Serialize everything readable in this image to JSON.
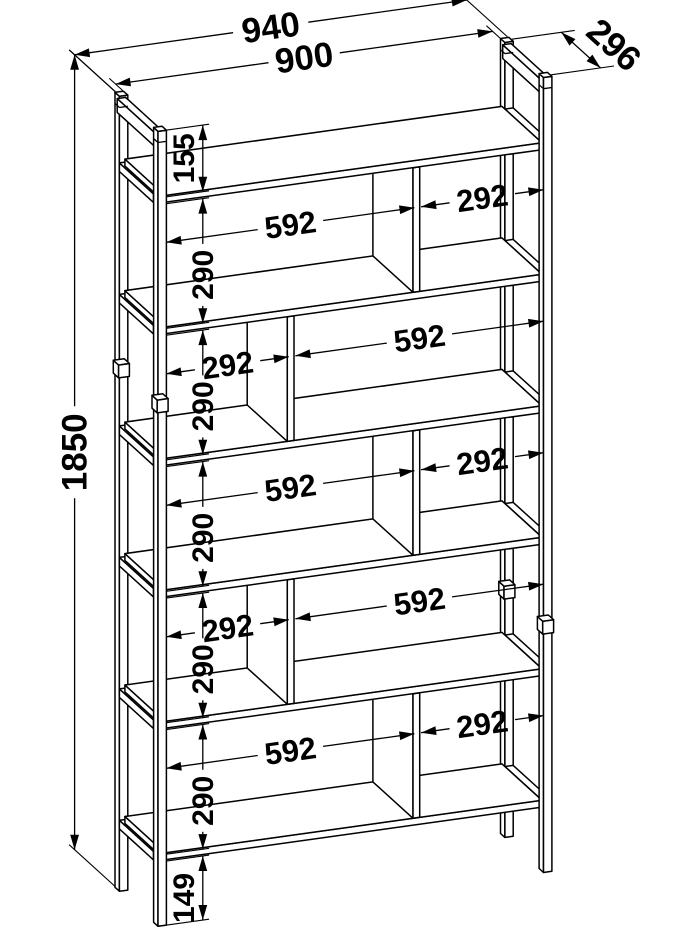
{
  "drawing": {
    "type": "technical-drawing",
    "subject": "staggered open shelving unit",
    "units": "mm",
    "overall": {
      "width": 940,
      "depth": 296,
      "height": 1850
    },
    "inner_width": 900,
    "top_clearance": 155,
    "row_clear_height": 290,
    "bottom_clearance": 149,
    "board_thickness": 16,
    "compartment_wide": 592,
    "compartment_narrow": 292,
    "shelf_tops": [
      165,
      471,
      777,
      1083,
      1389,
      1695
    ],
    "rows": [
      {
        "row": 1,
        "left": 592,
        "right": 292
      },
      {
        "row": 2,
        "left": 292,
        "right": 592
      },
      {
        "row": 3,
        "left": 592,
        "right": 292
      },
      {
        "row": 4,
        "left": 292,
        "right": 592
      },
      {
        "row": 5,
        "left": 592,
        "right": 292
      }
    ],
    "labels": {
      "overall_width": "940",
      "inner_width": "900",
      "depth": "296",
      "height": "1850",
      "top": "155",
      "row": "290",
      "bottom": "149",
      "wide": "592",
      "narrow": "292"
    },
    "line_color": "#000000",
    "background": "#ffffff"
  }
}
